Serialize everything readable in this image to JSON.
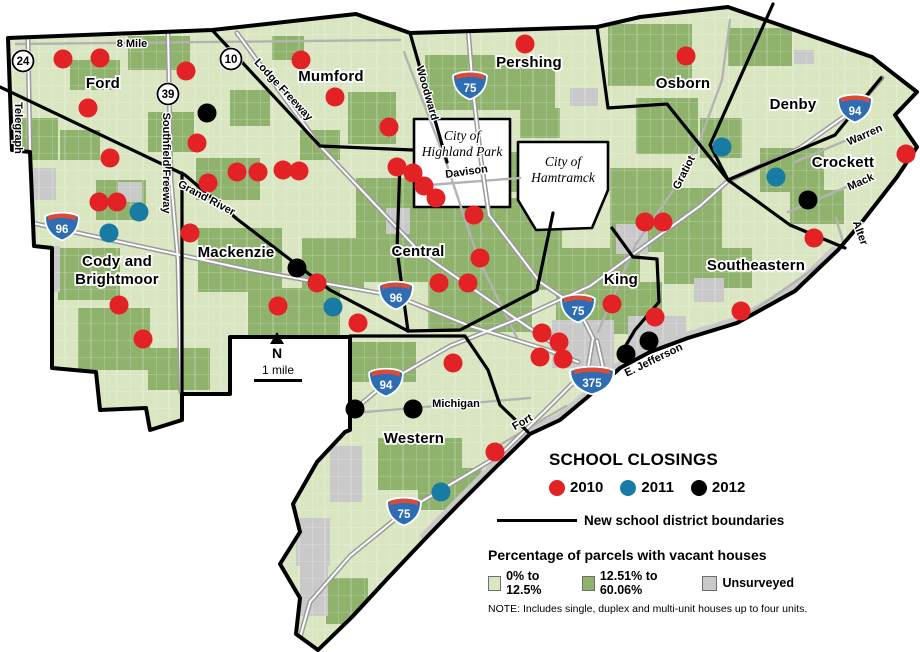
{
  "legend": {
    "title": "SCHOOL CLOSINGS",
    "years": [
      {
        "label": "2010",
        "color": "#e32226"
      },
      {
        "label": "2011",
        "color": "#177ba4"
      },
      {
        "label": "2012",
        "color": "#000000"
      }
    ],
    "boundary_label": "New school district boundaries",
    "vacancy_title": "Percentage of parcels with vacant houses",
    "vacancy_classes": [
      {
        "label": "0% to 12.5%",
        "color": "#d9e6c1"
      },
      {
        "label": "12.51% to 60.06%",
        "color": "#8fb36d"
      },
      {
        "label": "Unsurveyed",
        "color": "#c9c9c9"
      }
    ],
    "note": "NOTE: Includes single, duplex and multi-unit houses up to four units."
  },
  "map": {
    "colors": {
      "light_green": "#d9e6c1",
      "dark_green": "#8fb36d",
      "unsurveyed": "#c9c9c9",
      "red": "#e32226",
      "blue": "#177ba4",
      "black": "#000000",
      "road": "#b3b3b3",
      "freeway_casing": "#9b9b9b",
      "freeway_inner": "#ffffff",
      "shield_blue": "#2e6db4",
      "shield_red": "#dd4b36",
      "shore": "#c9c9c9"
    },
    "outline": "8,38 212,30 356,14 410,33 597,27 640,17 728,7 872,57 917,92 895,115 917,147 897,177 862,222 838,250 795,291 737,323 688,338 650,352 620,368 596,390 560,420 530,434 495,468 458,505 424,540 388,578 352,617 318,650 296,634 300,598 280,564 300,532 293,504 317,462 345,432 350,430 350,337 230,337 230,394 182,394 182,420 150,430 146,408 100,410 96,372 52,368 52,248 34,246 30,152 12,150",
    "shore": "838,250 795,291 737,323 688,338 650,352 620,368 596,390 560,420 530,434 495,468 458,505 424,540",
    "boundaries": [
      "0,87 185,175 237,219 330,290 408,331",
      "182,173 182,394",
      "213,31 320,146 413,150",
      "410,33 447,162",
      "400,162 397,250 408,331",
      "597,27 608,108 667,104 728,180",
      "773,4 710,145 728,180",
      "728,180 835,135 881,78",
      "728,180 790,225 845,248",
      "553,213 537,290 460,330 408,331",
      "612,228 633,257 657,259 659,302 635,330 622,352",
      "350,336 465,336 488,370 500,405 528,432"
    ],
    "holes": [
      {
        "name": "highland-park",
        "points": "414,119 510,119 510,207 414,207",
        "label": {
          "lines": [
            "City of",
            "Highland Park"
          ],
          "x": 462,
          "y": 140
        }
      },
      {
        "name": "hamtramck",
        "points": "518,142 608,142 608,190 592,228 536,230 518,200",
        "label": {
          "lines": [
            "City of",
            "Hamtramck"
          ],
          "x": 563,
          "y": 166
        }
      }
    ],
    "patches_dark": [
      [
        128,
        36,
        62,
        34
      ],
      [
        18,
        118,
        40,
        42
      ],
      [
        148,
        112,
        46,
        40
      ],
      [
        60,
        130,
        40,
        30
      ],
      [
        70,
        60,
        50,
        30
      ],
      [
        230,
        90,
        40,
        36
      ],
      [
        272,
        36,
        32,
        24
      ],
      [
        348,
        92,
        48,
        52
      ],
      [
        300,
        130,
        40,
        30
      ],
      [
        425,
        55,
        70,
        55
      ],
      [
        495,
        60,
        60,
        50
      ],
      [
        520,
        108,
        40,
        30
      ],
      [
        608,
        24,
        84,
        62
      ],
      [
        636,
        98,
        62,
        56
      ],
      [
        700,
        118,
        42,
        40
      ],
      [
        728,
        28,
        64,
        38
      ],
      [
        610,
        168,
        62,
        84
      ],
      [
        658,
        188,
        64,
        60
      ],
      [
        700,
        248,
        52,
        40
      ],
      [
        664,
        230,
        50,
        54
      ],
      [
        356,
        178,
        124,
        104
      ],
      [
        478,
        198,
        84,
        92
      ],
      [
        428,
        278,
        104,
        54
      ],
      [
        506,
        152,
        30,
        40
      ],
      [
        556,
        248,
        84,
        74
      ],
      [
        598,
        282,
        64,
        52
      ],
      [
        196,
        158,
        64,
        42
      ],
      [
        198,
        228,
        84,
        64
      ],
      [
        248,
        288,
        92,
        68
      ],
      [
        302,
        238,
        62,
        52
      ],
      [
        58,
        248,
        62,
        52
      ],
      [
        78,
        308,
        72,
        62
      ],
      [
        148,
        348,
        62,
        42
      ],
      [
        96,
        180,
        50,
        40
      ],
      [
        352,
        342,
        64,
        40
      ],
      [
        378,
        438,
        84,
        52
      ],
      [
        418,
        468,
        64,
        42
      ],
      [
        326,
        578,
        42,
        46
      ],
      [
        760,
        148,
        64,
        44
      ],
      [
        790,
        190,
        54,
        34
      ]
    ],
    "patches_gray": [
      [
        26,
        246,
        34,
        46
      ],
      [
        28,
        168,
        28,
        32
      ],
      [
        118,
        182,
        24,
        20
      ],
      [
        570,
        88,
        28,
        18
      ],
      [
        794,
        50,
        20,
        14
      ],
      [
        616,
        224,
        32,
        30
      ],
      [
        552,
        320,
        62,
        48
      ],
      [
        628,
        316,
        58,
        42
      ],
      [
        330,
        446,
        32,
        56
      ],
      [
        296,
        518,
        34,
        48
      ],
      [
        300,
        562,
        28,
        54
      ],
      [
        386,
        208,
        24,
        26
      ],
      [
        694,
        278,
        30,
        24
      ]
    ],
    "freeways": [
      {
        "name": "telegraph",
        "points": "28,40 30,150"
      },
      {
        "name": "southfield",
        "points": "168,32 171,180 178,260 181,392"
      },
      {
        "name": "lodge",
        "points": "237,33 320,146 420,252 525,325 560,348"
      },
      {
        "name": "i96",
        "points": "0,216 120,242 250,270 396,296 470,326 548,350 578,362"
      },
      {
        "name": "i75",
        "points": "468,28 473,90 481,160 489,215 540,282 578,308 593,338 588,368 550,406 500,455 441,490 404,512 350,556 310,602 299,641"
      },
      {
        "name": "i94",
        "points": "330,430 386,383 450,346 520,318 590,286 650,242 700,206 728,181 800,148 855,109 882,78"
      },
      {
        "name": "i375",
        "points": "597,341 604,372 603,396"
      }
    ],
    "streets": [
      {
        "name": "eight-mile",
        "points": "16,44 400,40"
      },
      {
        "name": "woodward",
        "points": "404,52 446,162 478,258 518,340"
      },
      {
        "name": "gratiot",
        "points": "598,332 636,244 672,192 700,140 722,80 730,20"
      },
      {
        "name": "michigan",
        "points": "342,414 530,398"
      },
      {
        "name": "fort",
        "points": "498,446 566,406"
      },
      {
        "name": "e-jefferson",
        "points": "598,392 660,358 740,320 838,252"
      },
      {
        "name": "warren",
        "points": "795,162 880,126"
      },
      {
        "name": "mack",
        "points": "788,212 872,176"
      },
      {
        "name": "alter",
        "points": "836,218 846,252"
      },
      {
        "name": "davison",
        "points": "416,186 520,178"
      }
    ],
    "shields_interstate": [
      {
        "n": "96",
        "x": 62,
        "y": 226
      },
      {
        "n": "96",
        "x": 396,
        "y": 295
      },
      {
        "n": "75",
        "x": 470,
        "y": 85
      },
      {
        "n": "75",
        "x": 578,
        "y": 308
      },
      {
        "n": "75",
        "x": 404,
        "y": 511
      },
      {
        "n": "94",
        "x": 386,
        "y": 382
      },
      {
        "n": "94",
        "x": 855,
        "y": 108
      },
      {
        "n": "375",
        "x": 592,
        "y": 380,
        "w": 1.3
      }
    ],
    "shields_circle": [
      {
        "n": "24",
        "x": 23,
        "y": 61
      },
      {
        "n": "10",
        "x": 231,
        "y": 59
      },
      {
        "n": "39",
        "x": 168,
        "y": 94
      }
    ],
    "road_labels": [
      {
        "t": "8 Mile",
        "x": 132,
        "y": 47,
        "r": 0
      },
      {
        "t": "Telegraph",
        "x": 15,
        "y": 128,
        "r": 90
      },
      {
        "t": "Southfield Freeway",
        "x": 163,
        "y": 163,
        "r": 90
      },
      {
        "t": "Lodge Freeway",
        "x": 281,
        "y": 92,
        "r": 47
      },
      {
        "t": "Grand River",
        "x": 205,
        "y": 201,
        "r": 28
      },
      {
        "t": "Woodward",
        "x": 424,
        "y": 94,
        "r": 74
      },
      {
        "t": "Davison",
        "x": 467,
        "y": 175,
        "r": -8
      },
      {
        "t": "Gratiot",
        "x": 687,
        "y": 174,
        "r": -63
      },
      {
        "t": "Warren",
        "x": 866,
        "y": 138,
        "r": -24
      },
      {
        "t": "Mack",
        "x": 862,
        "y": 185,
        "r": -24
      },
      {
        "t": "Alter",
        "x": 857,
        "y": 234,
        "r": 70
      },
      {
        "t": "E. Jefferson",
        "x": 655,
        "y": 363,
        "r": -26
      },
      {
        "t": "Michigan",
        "x": 456,
        "y": 407,
        "r": 0
      },
      {
        "t": "Fort",
        "x": 524,
        "y": 425,
        "r": -30
      }
    ],
    "district_labels": [
      {
        "lines": [
          "Ford"
        ],
        "x": 103,
        "y": 88
      },
      {
        "lines": [
          "Mumford"
        ],
        "x": 331,
        "y": 81
      },
      {
        "lines": [
          "Pershing"
        ],
        "x": 529,
        "y": 67
      },
      {
        "lines": [
          "Osborn"
        ],
        "x": 683,
        "y": 88
      },
      {
        "lines": [
          "Denby"
        ],
        "x": 793,
        "y": 109
      },
      {
        "lines": [
          "Crockett"
        ],
        "x": 843,
        "y": 167
      },
      {
        "lines": [
          "Cody and",
          "Brightmoor"
        ],
        "x": 117,
        "y": 266
      },
      {
        "lines": [
          "Mackenzie"
        ],
        "x": 236,
        "y": 257
      },
      {
        "lines": [
          "Central"
        ],
        "x": 418,
        "y": 256
      },
      {
        "lines": [
          "King"
        ],
        "x": 621,
        "y": 284
      },
      {
        "lines": [
          "Southeastern"
        ],
        "x": 756,
        "y": 270
      },
      {
        "lines": [
          "Western"
        ],
        "x": 414,
        "y": 443
      }
    ],
    "dots": {
      "2010": [
        [
          63,
          59
        ],
        [
          100,
          58
        ],
        [
          186,
          71
        ],
        [
          88,
          108
        ],
        [
          197,
          143
        ],
        [
          110,
          158
        ],
        [
          99,
          202
        ],
        [
          117,
          202
        ],
        [
          190,
          233
        ],
        [
          119,
          305
        ],
        [
          143,
          339
        ],
        [
          208,
          183
        ],
        [
          237,
          172
        ],
        [
          258,
          172
        ],
        [
          283,
          170
        ],
        [
          299,
          171
        ],
        [
          301,
          60
        ],
        [
          335,
          97
        ],
        [
          389,
          127
        ],
        [
          397,
          167
        ],
        [
          413,
          173
        ],
        [
          424,
          186
        ],
        [
          436,
          198
        ],
        [
          474,
          215
        ],
        [
          525,
          44
        ],
        [
          686,
          56
        ],
        [
          480,
          258
        ],
        [
          439,
          283
        ],
        [
          468,
          283
        ],
        [
          358,
          323
        ],
        [
          317,
          283
        ],
        [
          278,
          306
        ],
        [
          612,
          304
        ],
        [
          655,
          317
        ],
        [
          542,
          333
        ],
        [
          559,
          342
        ],
        [
          540,
          357
        ],
        [
          563,
          359
        ],
        [
          453,
          363
        ],
        [
          495,
          452
        ],
        [
          645,
          222
        ],
        [
          663,
          222
        ],
        [
          741,
          311
        ],
        [
          814,
          238
        ],
        [
          906,
          154
        ]
      ],
      "2011": [
        [
          139,
          212
        ],
        [
          109,
          233
        ],
        [
          333,
          307
        ],
        [
          722,
          147
        ],
        [
          776,
          177
        ],
        [
          441,
          492
        ]
      ],
      "2012": [
        [
          207,
          113
        ],
        [
          297,
          268
        ],
        [
          355,
          409
        ],
        [
          413,
          409
        ],
        [
          626,
          354
        ],
        [
          649,
          341
        ],
        [
          808,
          200
        ]
      ]
    },
    "north": {
      "x": 277,
      "y": 348,
      "n_label": "N",
      "scale_label": "1 mile"
    }
  }
}
